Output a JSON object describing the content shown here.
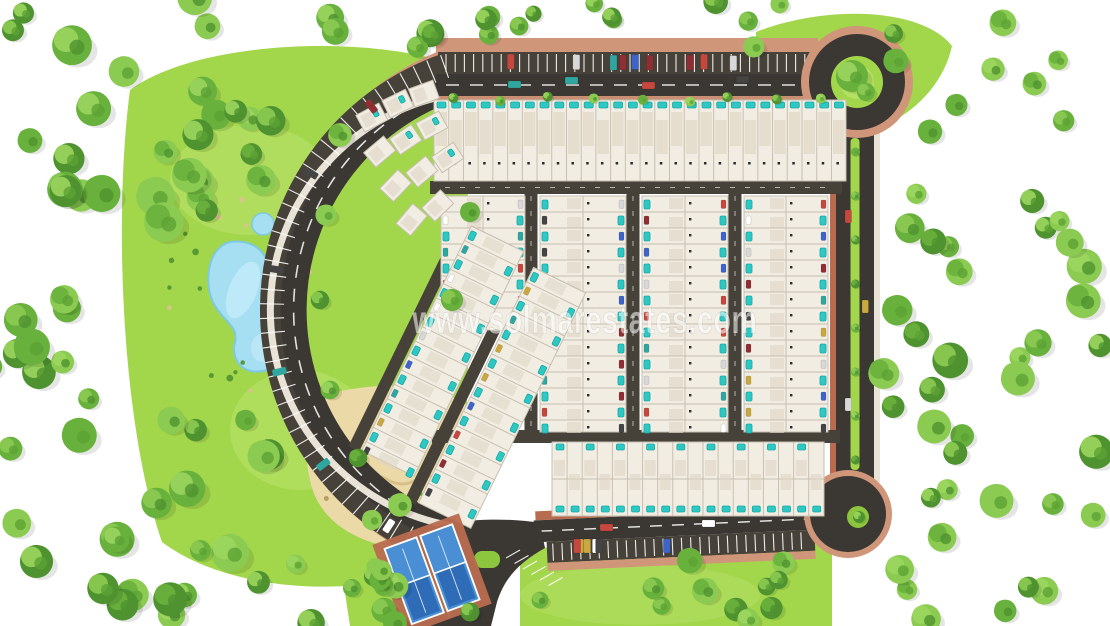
{
  "watermark": {
    "text": "www.solmarestates.com"
  },
  "site": {
    "feature_names": [
      "roundabout",
      "cul-de-sac",
      "ring-road",
      "perimeter-parking",
      "villa-rows",
      "pools",
      "pond",
      "sand-playground",
      "paddle-courts",
      "tree-belt",
      "entrance-junction",
      "median-strip"
    ]
  },
  "colors": {
    "background": "#ffffff",
    "grass": "#a2d64b",
    "grass_light": "#bce46d",
    "grass_dark": "#8cc53e",
    "tree_dark": "#4f9230",
    "tree_mid": "#69b13d",
    "tree_light": "#8ccb52",
    "road": "#3b3733",
    "road_band": "#474239",
    "brick": "#b96b4f",
    "brick_light": "#d0967a",
    "sidewalk": "#e9e3d7",
    "house": "#f2ede3",
    "house_shade": "#ddd5c5",
    "divider": "#c7bfb0",
    "pool": "#2fc7c2",
    "pool_dark": "#17a9a6",
    "pond": "#a7dff2",
    "pond_light": "#c6ecf9",
    "sand": "#ecd9a8",
    "sand_dark": "#d8bf8a",
    "court_blue": "#4a8fd4",
    "court_dark": "#2f6cb8",
    "white": "#ffffff"
  }
}
